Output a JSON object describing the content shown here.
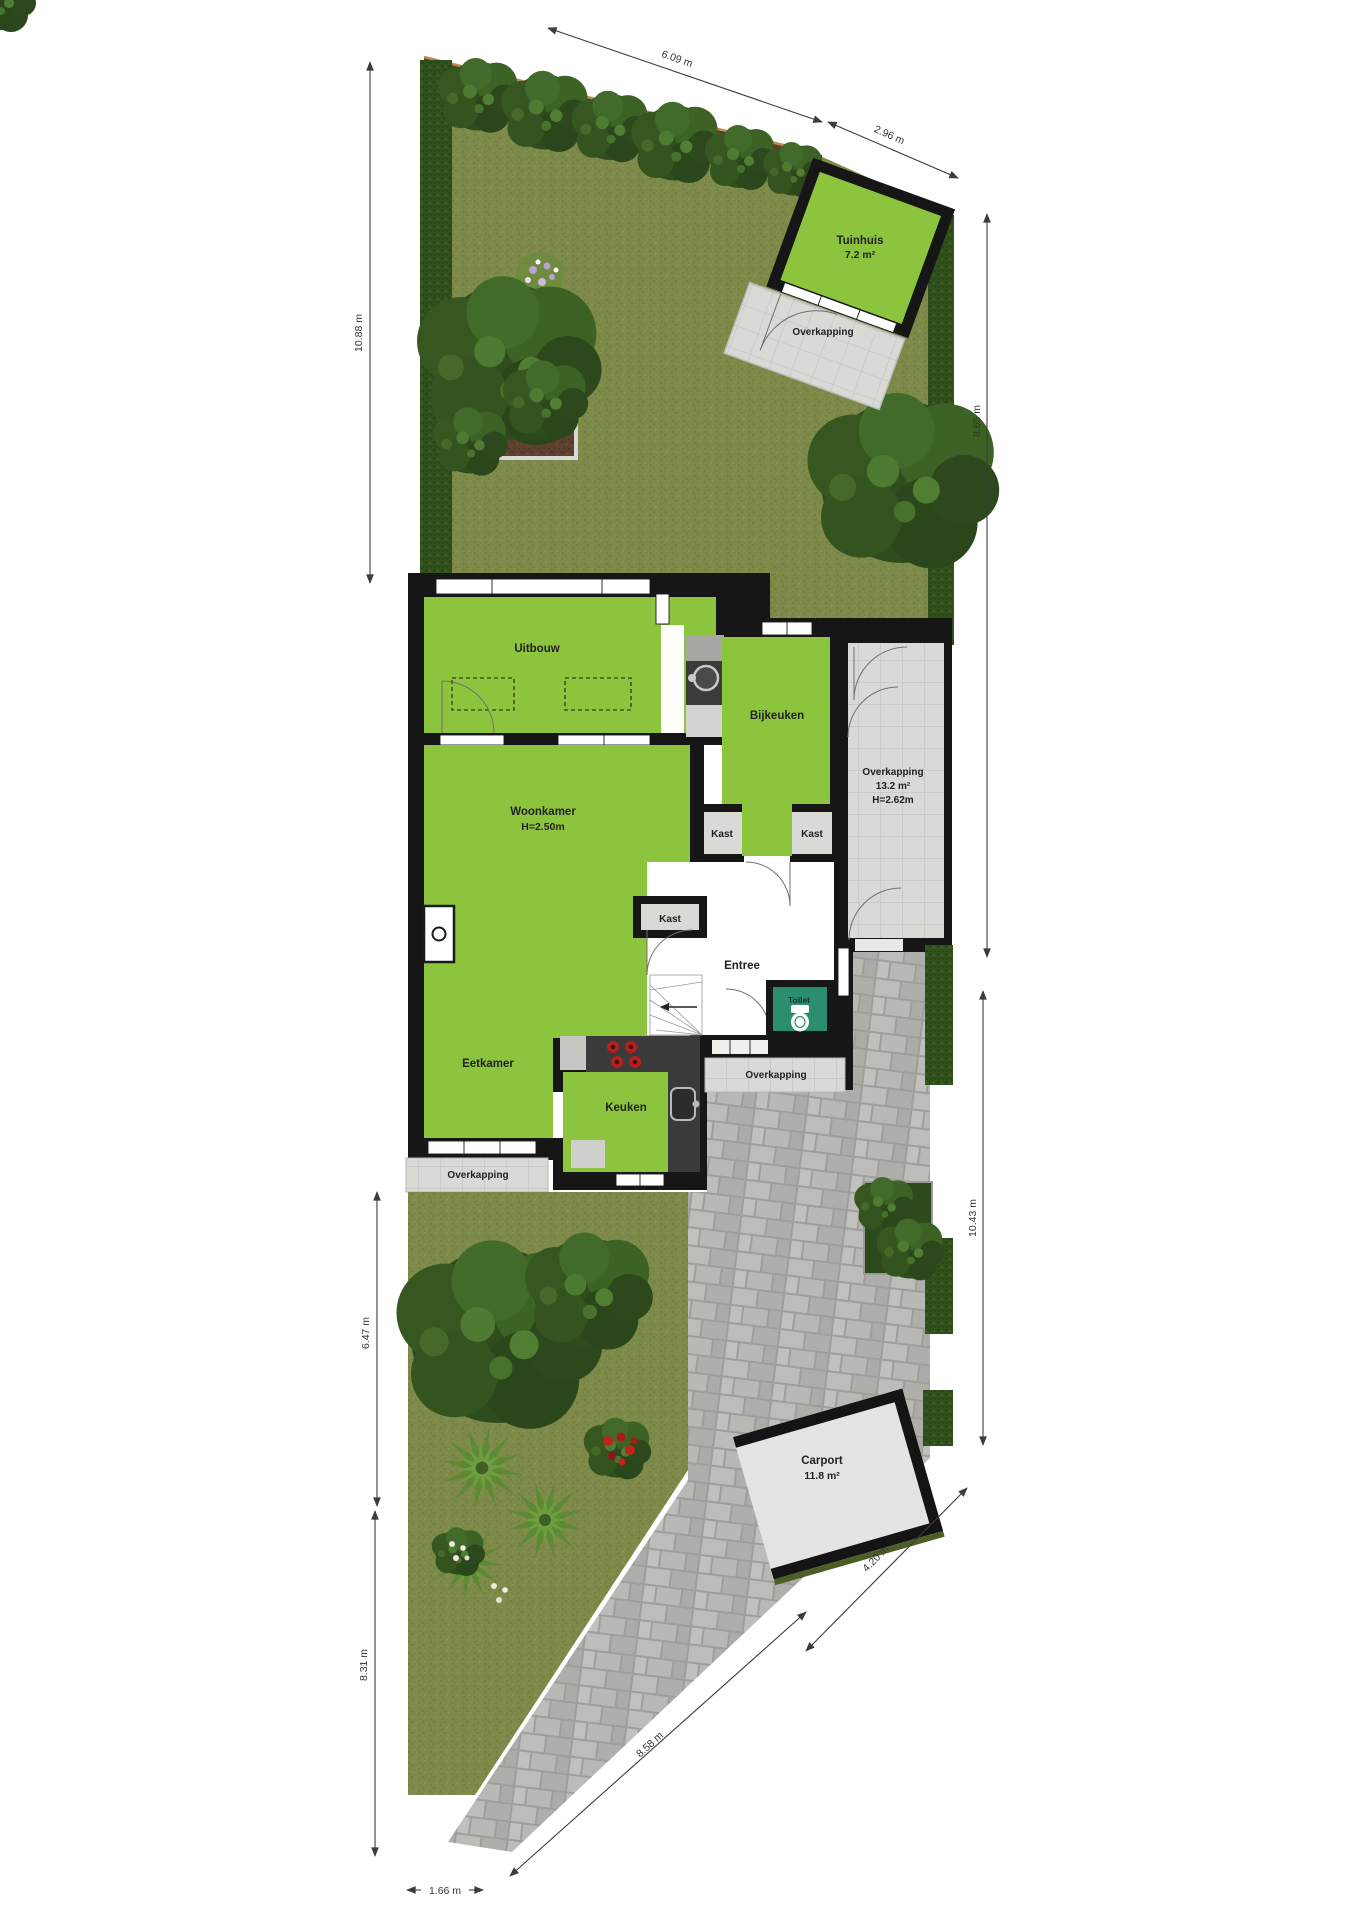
{
  "rooms": {
    "tuinhuis": {
      "label": "Tuinhuis",
      "area": "7.2 m²"
    },
    "tuinhuis_overkapping": {
      "label": "Overkapping"
    },
    "uitbouw": {
      "label": "Uitbouw"
    },
    "bijkeuken": {
      "label": "Bijkeuken"
    },
    "overkapping_zij": {
      "label": "Overkapping",
      "area": "13.2 m²",
      "height": "H=2.62m"
    },
    "woonkamer": {
      "label": "Woonkamer",
      "height": "H=2.50m"
    },
    "kast_links": {
      "label": "Kast"
    },
    "kast_rechts": {
      "label": "Kast"
    },
    "kast_hal": {
      "label": "Kast"
    },
    "entree": {
      "label": "Entree"
    },
    "toilet": {
      "label": "Toilet"
    },
    "eetkamer": {
      "label": "Eetkamer"
    },
    "keuken": {
      "label": "Keuken"
    },
    "overkapping_entree": {
      "label": "Overkapping"
    },
    "overkapping_eetkamer": {
      "label": "Overkapping"
    },
    "carport": {
      "label": "Carport",
      "area": "11.8 m²"
    }
  },
  "dimensions": {
    "top_left_slope": "6.09 m",
    "top_right_slope": "2.96 m",
    "back_left": "10.88 m",
    "back_right": "8.65 m",
    "front_right": "10.43 m",
    "front_left_upper": "6.47 m",
    "front_left_lower": "8.31 m",
    "carport_edge": "4.20 m",
    "driveway_edge": "8.58 m",
    "bottom_width": "1.66 m"
  },
  "colors": {
    "room_green": "#8cc53d",
    "toilet_teal": "#2b8e6f",
    "wall_black": "#161616",
    "paving_gray": "#b3b3b0",
    "canopy_gray": "#d9d9d6",
    "grass_green": "#7d8a49",
    "hedge_green": "#30511b",
    "soil_brown": "#5e4130"
  }
}
